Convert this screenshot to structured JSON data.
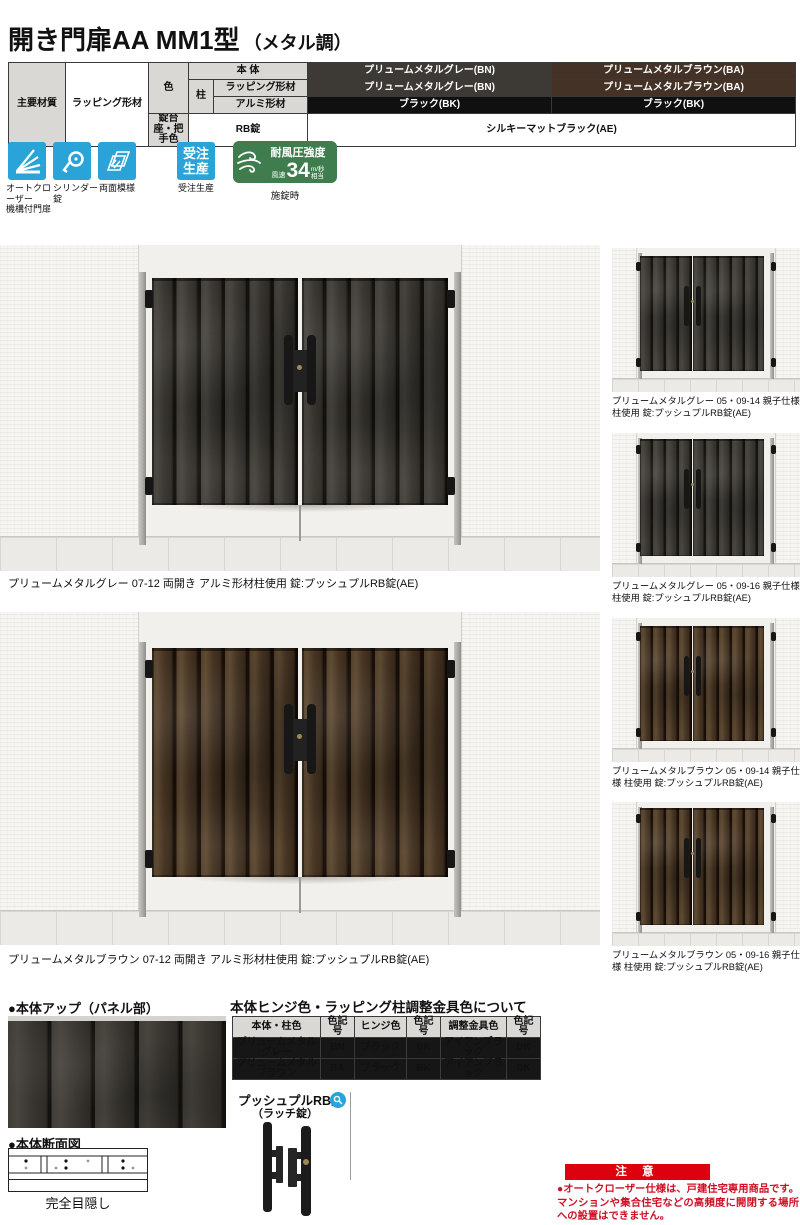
{
  "page": {
    "title_main": "開き門扉AA MM1型",
    "title_sub": "（メタル調）"
  },
  "spec": {
    "main_material_label": "主要材質",
    "main_material_value": "ラッピング形材",
    "color_label": "色",
    "lock_base_label": "錠台座・把手色",
    "body_label": "本 体",
    "pillar_label": "柱",
    "wrap_label": "ラッピング形材",
    "alum_label": "アルミ形材",
    "rb_label": "RB錠",
    "body_gray": "プリュームメタルグレー(BN)",
    "body_brown": "プリュームメタルブラウン(BA)",
    "wrap_gray": "プリュームメタルグレー(BN)",
    "wrap_brown": "プリュームメタルブラウン(BA)",
    "alum_black_left": "ブラック(BK)",
    "alum_black_right": "ブラック(BK)",
    "rb_value": "シルキーマットブラック(AE)"
  },
  "features": {
    "auto_closer_label": "オートクローザー\n機構付門扉",
    "cylinder_label": "シリンダー錠",
    "double_label": "両面模様",
    "order_line1": "受注",
    "order_line2": "生産",
    "order_label": "受注生産",
    "wind_title": "耐風圧強度",
    "wind_prefix": "風速",
    "wind_value": "34",
    "wind_unit_top": "m/秒",
    "wind_unit_bottom": "相当",
    "wind_label": "施錠時"
  },
  "photos": {
    "main1_caption": "プリュームメタルグレー 07-12 両開き アルミ形材柱使用 錠:プッシュプルRB錠(AE)",
    "main2_caption": "プリュームメタルブラウン 07-12 両開き アルミ形材柱使用 錠:プッシュプルRB錠(AE)",
    "thumb1_caption": "プリュームメタルグレー 05・09-14 親子仕様 柱使用 錠:プッシュプルRB錠(AE)",
    "thumb2_caption": "プリュームメタルグレー 05・09-16 親子仕様 柱使用 錠:プッシュプルRB錠(AE)",
    "thumb3_caption": "プリュームメタルブラウン 05・09-14 親子仕様 柱使用 錠:プッシュプルRB錠(AE)",
    "thumb4_caption": "プリュームメタルブラウン 05・09-16 親子仕様 柱使用 錠:プッシュプルRB錠(AE)"
  },
  "details": {
    "body_up_heading": "●本体アップ（パネル部）",
    "cross_heading": "●本体断面図",
    "cross_caption": "完全目隠し",
    "hinge_heading": "本体ヒンジ色・ラッピング柱調整金具色について",
    "hinge_headers": [
      "本体・柱色",
      "色記号",
      "ヒンジ色",
      "色記号",
      "調整金具色",
      "色記号"
    ],
    "hinge_rows": [
      [
        "プリュームメタルグレー",
        "BN",
        "ブラック",
        "BK",
        "アイアンブラック",
        "DK"
      ],
      [
        "プリュームメタルブラウン",
        "BA",
        "ブラック",
        "BK",
        "アイアンブラック",
        "DK"
      ]
    ],
    "lock_title": "プッシュプルRB錠",
    "lock_subtitle": "（ラッチ錠）"
  },
  "notice": {
    "title": "注 意",
    "text": "●オートクローザー仕様は、戸建住宅専用商品です。マンションや集合住宅などの高頻度に開閉する場所への設置はできません。"
  },
  "colors": {
    "accent_blue": "#29a3d8",
    "accent_green": "#3f7d4e",
    "accent_red": "#dd000f",
    "swatch_gray": "#3d3a36",
    "swatch_brown": "#443226",
    "swatch_black": "#101010"
  }
}
